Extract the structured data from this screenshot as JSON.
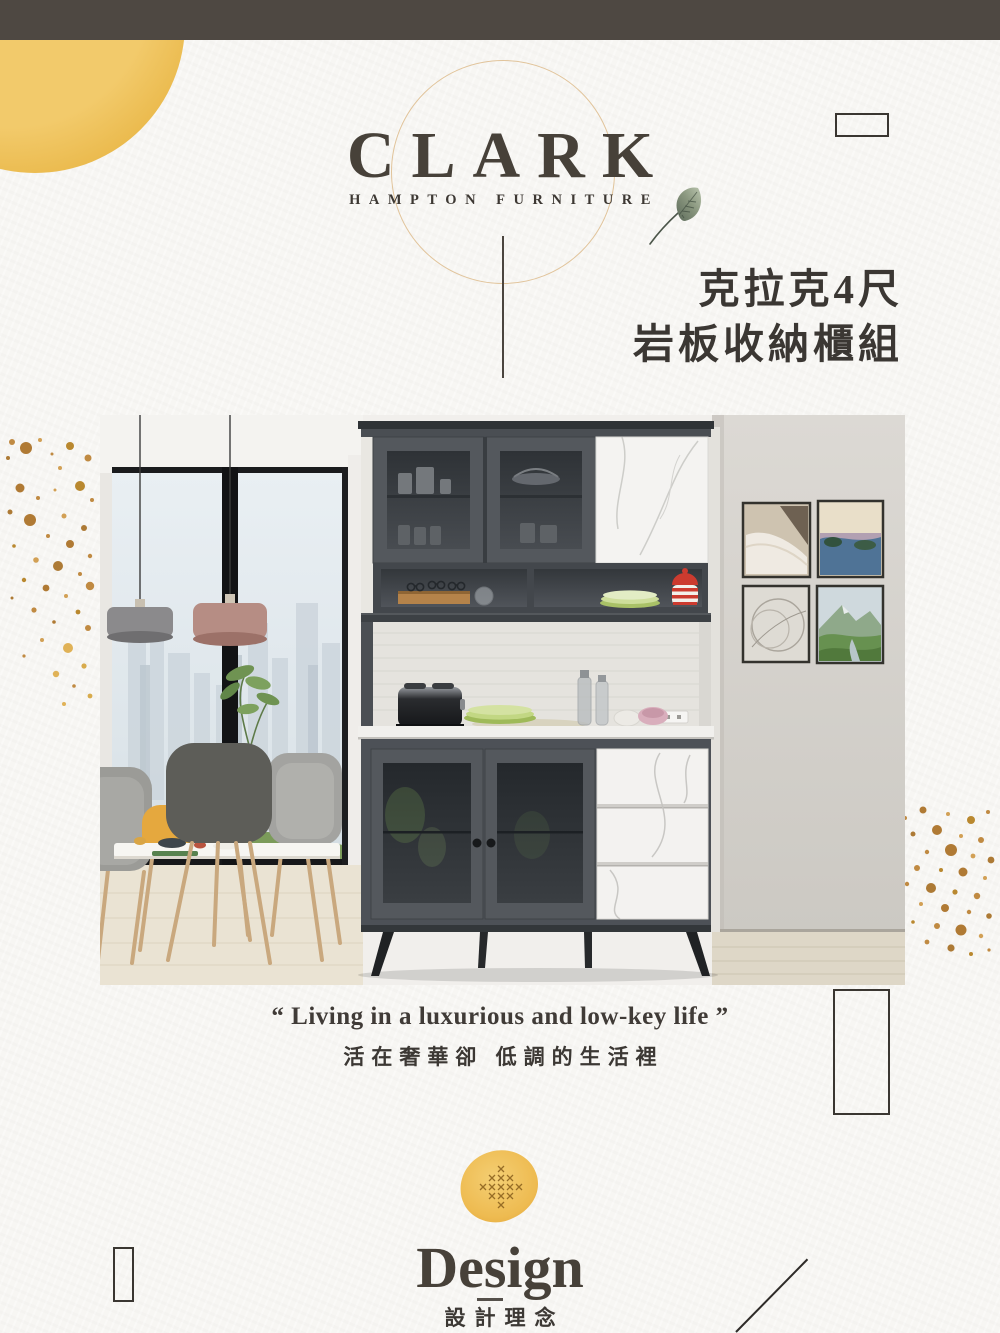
{
  "brand": {
    "name": "CLARK",
    "subtitle": "HAMPTON FURNITURE",
    "circle_color": "#e1c49b"
  },
  "product_title": {
    "line1": "克拉克4尺",
    "line2": "岩板收納櫃組"
  },
  "quote": {
    "en": "“ Living in a luxurious and low-key life ”",
    "zh": "活在奢華卻 低調的生活裡"
  },
  "design": {
    "title": "Design",
    "subtitle": "設計理念"
  },
  "colors": {
    "top_bar": "#4e4842",
    "background": "#f7f6f3",
    "text_dark": "#3c3834",
    "accent_yellow": "#edc05a",
    "splatter_gold": "#bf8a42"
  },
  "icons": {
    "leaf": "leaf-icon",
    "ink_blob": "ink-blob-icon",
    "corner_circle": "corner-circle-decoration"
  }
}
